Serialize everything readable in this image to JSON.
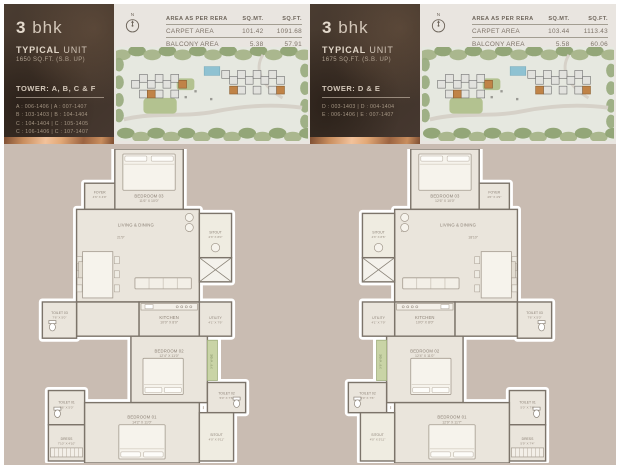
{
  "cards": [
    {
      "bhk_number": "3",
      "bhk_suffix": "bhk",
      "typical": "TYPICAL",
      "unit": "UNIT",
      "area_note": "1650 SQ.FT. (S.B. UP)",
      "tower_line": "TOWER: A, B, C & F",
      "units_list": [
        "A : 006-1406 | A : 007-1407",
        "B : 103-1403 | B : 104-1404",
        "C : 104-1404 | C : 105-1405",
        "C : 106-1406 | C : 107-1407",
        "F : 103-1303 | F : 104-1304"
      ],
      "compass_n": "N",
      "area_table": {
        "col_area": "AREA AS PER RERA",
        "col_sqmt": "SQ.MT.",
        "col_sqft": "SQ.FT.",
        "rows": [
          {
            "label": "CARPET AREA",
            "sqmt": "101.42",
            "sqft": "1091.68"
          },
          {
            "label": "BALCONY AREA",
            "sqmt": "5.38",
            "sqft": "57.91"
          }
        ]
      },
      "rooms": {
        "bedroom03": {
          "name": "BEDROOM 03",
          "dims": "11'6\" X 10'0\""
        },
        "foyer": {
          "name": "FOYER",
          "dims": "4'6\" X 4'9\""
        },
        "living": {
          "name": "LIVING & DINING",
          "dim_w": "21'9\"",
          "dim_h": "17'5\""
        },
        "sitout_upper": {
          "name": "SITOUT",
          "dims": "4'3\" X 8'0\""
        },
        "kitchen": {
          "name": "KITCHEN",
          "dims": "10'0\" X 8'0\""
        },
        "utility": {
          "name": "UTILITY",
          "dims": "4'1\" X 7'9\""
        },
        "toilet03": {
          "name": "TOILET 03",
          "dims": "7'6\" X 5'0\""
        },
        "bedroom02": {
          "name": "BEDROOM 02",
          "dims": "12'4\" X 11'0\""
        },
        "planter": {
          "label": "3'6\" WIDE"
        },
        "toilet02": {
          "name": "TOILET 02",
          "dims": "5'0\" X 7'6\""
        },
        "toilet01": {
          "name": "TOILET 01",
          "dims": "7'6\" X 5'0\""
        },
        "dress": {
          "name": "DRESS",
          "dims": "7'10\" X 4'10\""
        },
        "bedroom01": {
          "name": "BEDROOM 01",
          "dims": "14'2\" X 11'0\""
        },
        "sitout_lower": {
          "name": "SITOUT",
          "dims": "4'0\" X 9'11\""
        }
      }
    },
    {
      "bhk_number": "3",
      "bhk_suffix": "bhk",
      "typical": "TYPICAL",
      "unit": "UNIT",
      "area_note": "1675 SQ.FT. (S.B. UP)",
      "tower_line": "TOWER: D & E",
      "units_list": [
        "D : 003-1403 | D : 004-1404",
        "E : 006-1406 | E : 007-1407"
      ],
      "compass_n": "N",
      "area_table": {
        "col_area": "AREA AS PER RERA",
        "col_sqmt": "SQ.MT.",
        "col_sqft": "SQ.FT.",
        "rows": [
          {
            "label": "CARPET AREA",
            "sqmt": "103.44",
            "sqft": "1113.43"
          },
          {
            "label": "BALCONY AREA",
            "sqmt": "5.58",
            "sqft": "60.06"
          }
        ]
      },
      "rooms": {
        "bedroom03": {
          "name": "BEDROOM 03",
          "dims": "12'6\" X 10'0\""
        },
        "foyer": {
          "name": "FOYER",
          "dims": "4'6\" X 4'9\""
        },
        "living": {
          "name": "LIVING & DINING",
          "dim_w": "18'10\"",
          "dim_h": "17'6\""
        },
        "sitout_upper": {
          "name": "SITOUT",
          "dims": "4'3\" X 8'6\""
        },
        "kitchen": {
          "name": "KITCHEN",
          "dims": "10'0\" X 8'0\""
        },
        "utility": {
          "name": "UTILITY",
          "dims": "4'1\" X 7'9\""
        },
        "toilet03": {
          "name": "TOILET 03",
          "dims": "7'6\" X 5'0\""
        },
        "bedroom02": {
          "name": "BEDROOM 02",
          "dims": "12'4\" X 11'0\""
        },
        "planter": {
          "label": "3'6\" WIDE"
        },
        "toilet02": {
          "name": "TOILET 02",
          "dims": "5'0\" X 7'6\""
        },
        "toilet01": {
          "name": "TOILET 01",
          "dims": "5'0\" X 7'6\""
        },
        "dress": {
          "name": "DRESS",
          "dims": "5'9\" X 7'4\""
        },
        "bedroom01": {
          "name": "BEDROOM 01",
          "dims": "12'9\" X 11'7\""
        },
        "sitout_lower": {
          "name": "SITOUT",
          "dims": "4'0\" X 5'11\""
        }
      }
    }
  ]
}
